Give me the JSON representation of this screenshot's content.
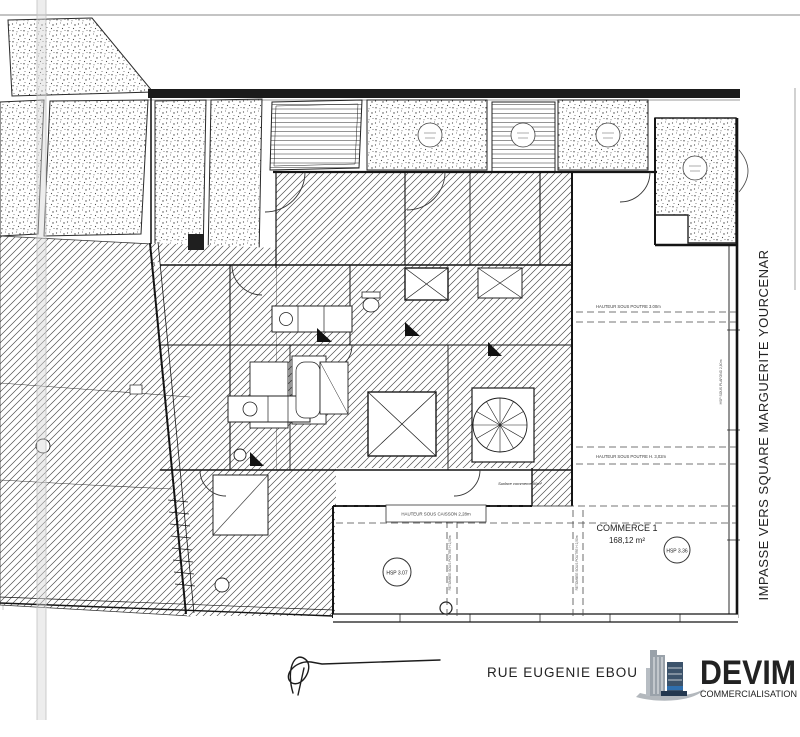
{
  "plan": {
    "commerce": {
      "name": "COMMERCE 1",
      "area": "168,12 m²",
      "surface_note": "Surface commerce 90m²"
    },
    "hsp_markers": [
      {
        "label": "HSP 3.07"
      },
      {
        "label": "HSP 3.36"
      }
    ],
    "annotations": {
      "beam_top": "HAUTEUR SOUS POUTRE 3.00m",
      "beam_mid": "HAUTEUR SOUS POUTRE H. 3,02m",
      "caisson_box": "HAUTEUR SOUS CAISSON 2,28m",
      "beam_vert_left": "RETOMBEE SOUS POUTRE H 2,50m",
      "beam_vert_right": "RETOMBEE SOUS POUTRE H 2,50m",
      "hsp_wall": "HSP SOUS PLAFOND 2,80m"
    }
  },
  "streets": {
    "bottom": "RUE EUGENIE EBOU",
    "right": "IMPASSE VERS SQUARE MARGUERITE YOURCENAR"
  },
  "logo": {
    "brand": "DEVIM",
    "tagline": "COMMERCIALISATION"
  },
  "colors": {
    "ink": "#1a1a1a",
    "logo_blue": "#2f6fae",
    "logo_navy": "#1d3a5f",
    "logo_gray": "#8d949b"
  }
}
